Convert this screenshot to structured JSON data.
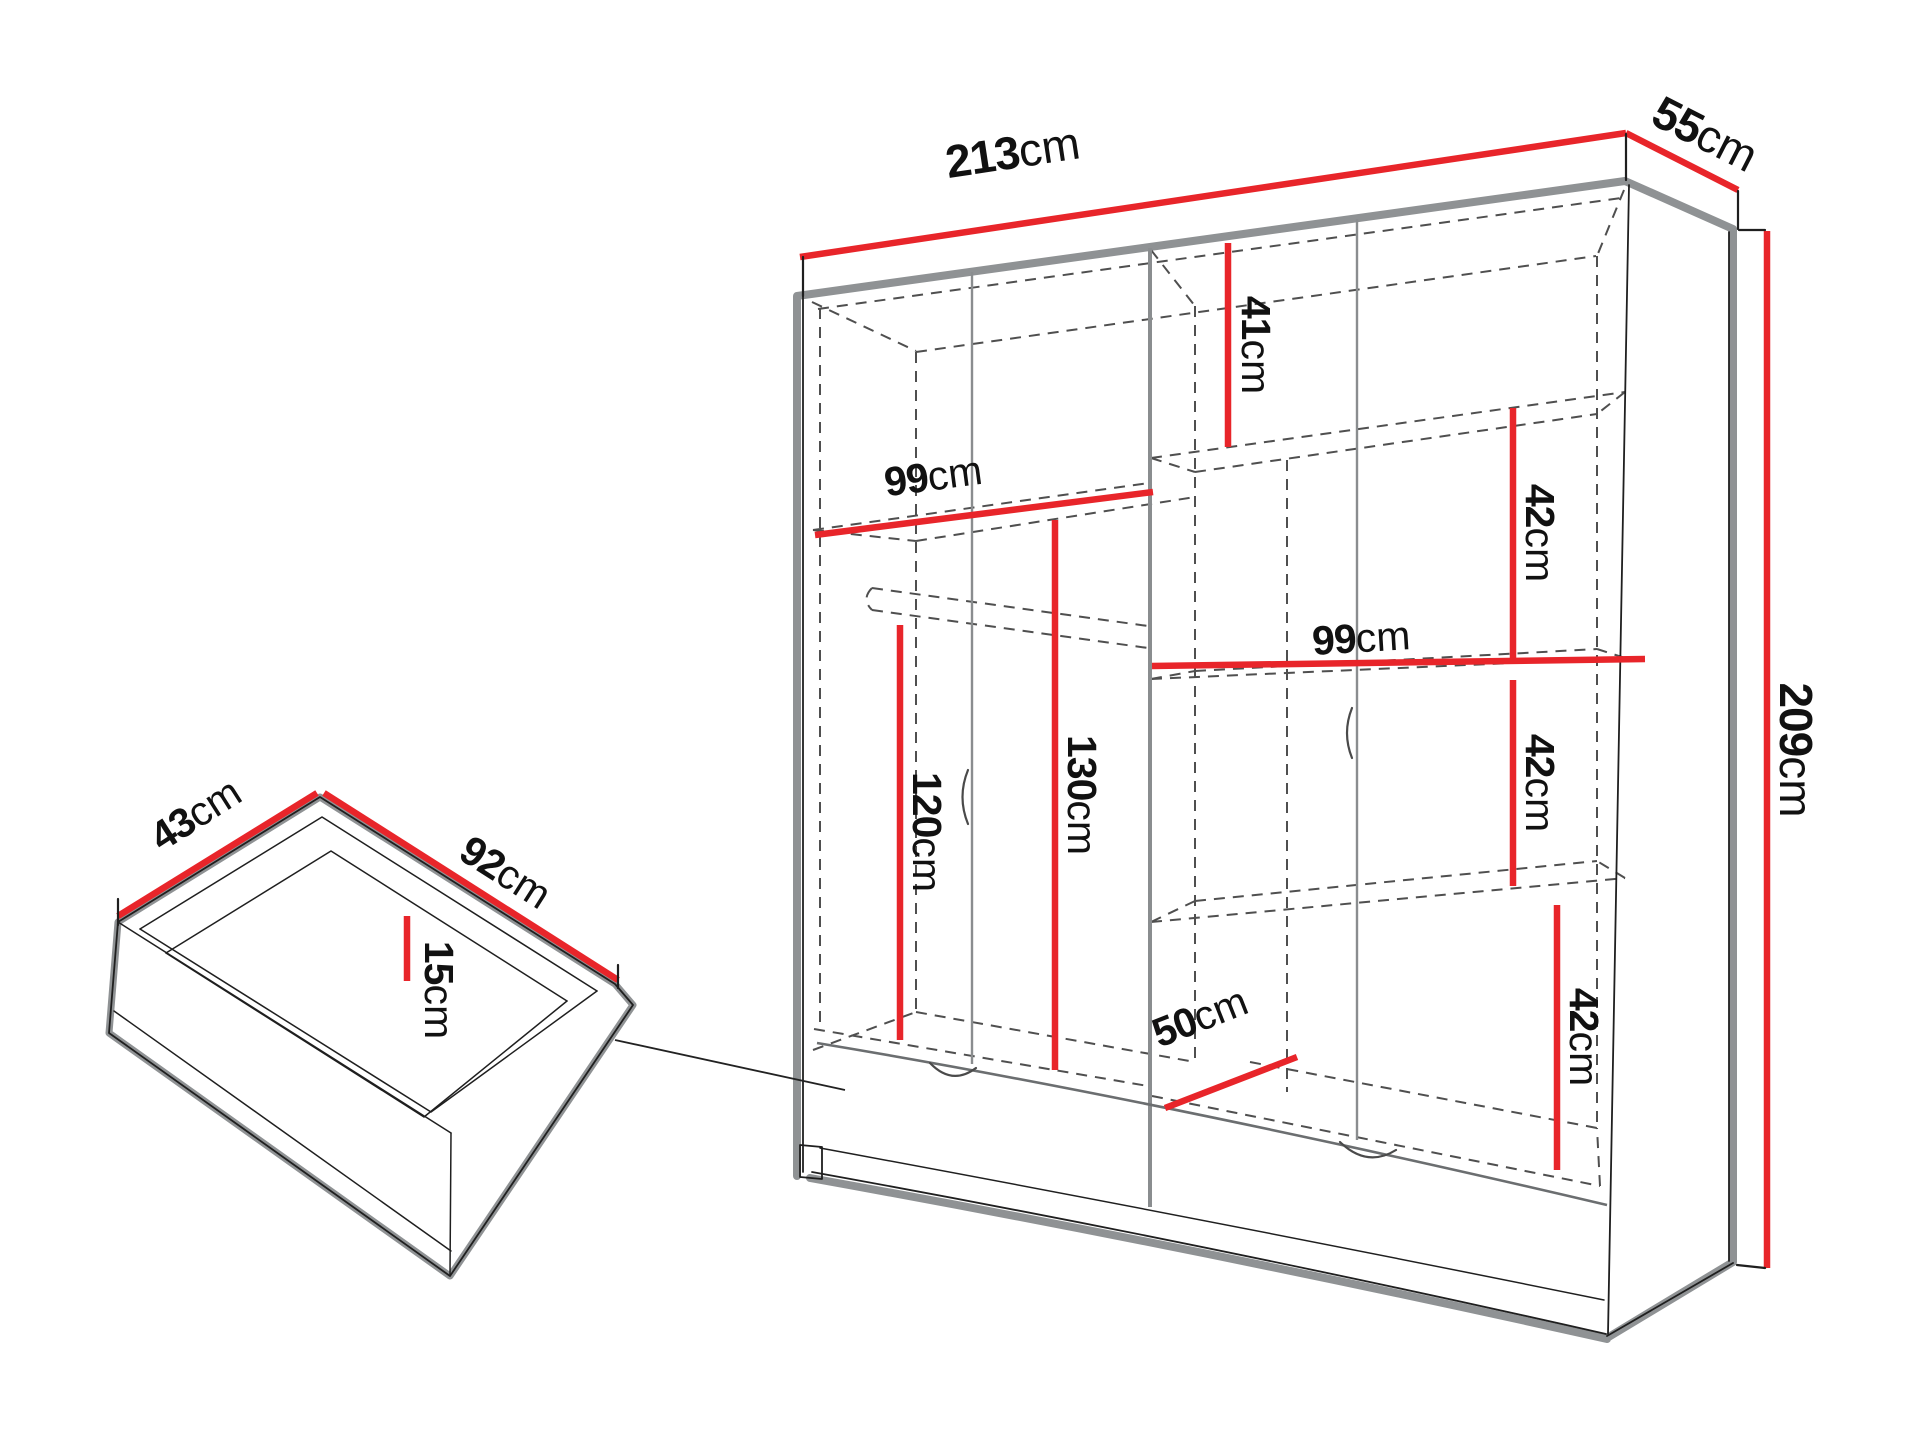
{
  "page": {
    "background": "#ffffff",
    "description": "Technical dimension diagram of a wardrobe with interior shelving and a detached drawer detail"
  },
  "colors": {
    "dimension_red": "#e8252a",
    "outline_black": "#1f1f1f",
    "shadow_gray": "#8f9294",
    "dashed_gray": "#4f4f4f",
    "label_black": "#111111"
  },
  "wardrobe": {
    "dimensions": {
      "width": "213cm",
      "depth": "55cm",
      "height": "209cm",
      "top_shelf_height": "41cm",
      "left_section_width": "99cm",
      "right_section_width": "99cm",
      "shelf_gap_top": "42cm",
      "shelf_gap_middle": "42cm",
      "shelf_gap_bottom": "42cm",
      "hanging_space_left": "120cm",
      "hanging_space_center": "130cm",
      "drawer_recess_depth": "50cm"
    }
  },
  "drawer": {
    "dimensions": {
      "depth": "43cm",
      "width": "92cm",
      "height": "15cm"
    }
  }
}
